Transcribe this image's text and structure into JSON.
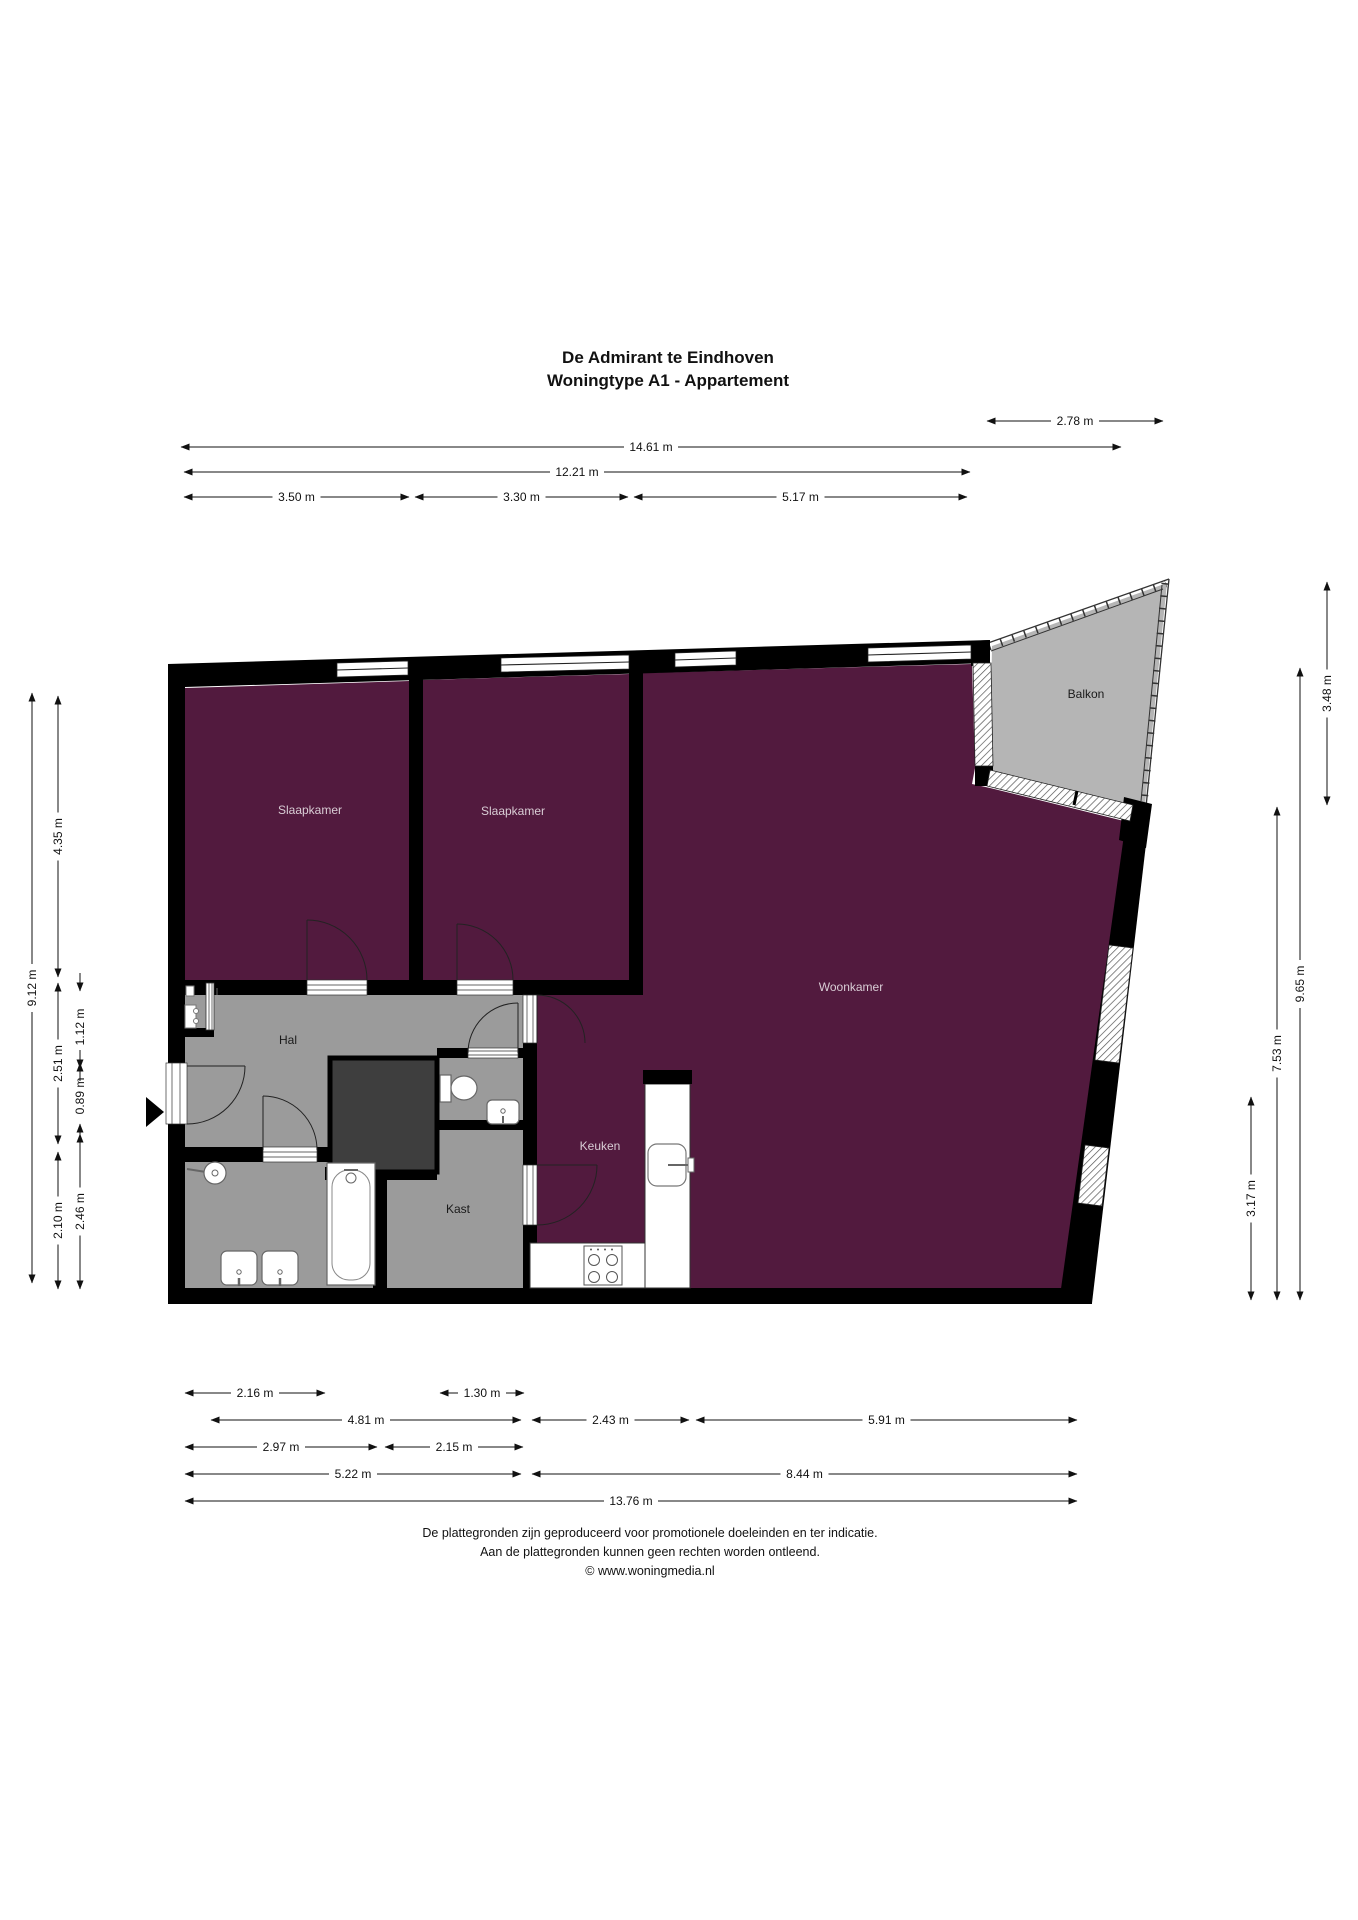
{
  "title": {
    "line1": "De Admirant te Eindhoven",
    "line2": "Woningtype A1 - Appartement"
  },
  "rooms": [
    {
      "name": "Slaapkamer",
      "x": 310,
      "y": 814,
      "tone": "light"
    },
    {
      "name": "Slaapkamer",
      "x": 513,
      "y": 815,
      "tone": "light"
    },
    {
      "name": "Woonkamer",
      "x": 851,
      "y": 991,
      "tone": "light"
    },
    {
      "name": "Keuken",
      "x": 600,
      "y": 1150,
      "tone": "light"
    },
    {
      "name": "Hal",
      "x": 288,
      "y": 1044,
      "tone": "dark"
    },
    {
      "name": "Kast",
      "x": 458,
      "y": 1213,
      "tone": "dark"
    },
    {
      "name": "Balkon",
      "x": 1086,
      "y": 698,
      "tone": "dark"
    }
  ],
  "dimensions": {
    "top": [
      {
        "label": "2.78 m",
        "x1": 987,
        "x2": 1163,
        "y": 421
      },
      {
        "label": "14.61 m",
        "x1": 181,
        "x2": 1121,
        "y": 447
      },
      {
        "label": "12.21 m",
        "x1": 184,
        "x2": 970,
        "y": 472
      },
      {
        "label": "3.50 m",
        "x1": 184,
        "x2": 409,
        "y": 497
      },
      {
        "label": "3.30 m",
        "x1": 415,
        "x2": 628,
        "y": 497
      },
      {
        "label": "5.17 m",
        "x1": 634,
        "x2": 967,
        "y": 497
      }
    ],
    "bottom": [
      {
        "label": "2.16 m",
        "x1": 185,
        "x2": 325,
        "y": 1393
      },
      {
        "label": "1.30 m",
        "x1": 440,
        "x2": 524,
        "y": 1393
      },
      {
        "label": "4.81 m",
        "x1": 211,
        "x2": 521,
        "y": 1420
      },
      {
        "label": "2.43 m",
        "x1": 532,
        "x2": 689,
        "y": 1420
      },
      {
        "label": "5.91 m",
        "x1": 696,
        "x2": 1077,
        "y": 1420
      },
      {
        "label": "2.97 m",
        "x1": 185,
        "x2": 377,
        "y": 1447
      },
      {
        "label": "2.15 m",
        "x1": 385,
        "x2": 523,
        "y": 1447
      },
      {
        "label": "5.22 m",
        "x1": 185,
        "x2": 521,
        "y": 1474
      },
      {
        "label": "8.44 m",
        "x1": 532,
        "x2": 1077,
        "y": 1474
      },
      {
        "label": "13.76 m",
        "x1": 185,
        "x2": 1077,
        "y": 1501
      }
    ],
    "left": [
      {
        "label": "9.12 m",
        "y1": 693,
        "y2": 1283,
        "x": 32
      },
      {
        "label": "4.35 m",
        "y1": 696,
        "y2": 977,
        "x": 58
      },
      {
        "label": "2.51 m",
        "y1": 983,
        "y2": 1144,
        "x": 58
      },
      {
        "label": "2.10 m",
        "y1": 1152,
        "y2": 1289,
        "x": 58
      },
      {
        "label": "1.12 m",
        "y1": 991,
        "y2": 1063,
        "x": 80
      },
      {
        "label": "0.89 m",
        "y1": 1068,
        "y2": 1124,
        "x": 80
      },
      {
        "label": "2.46 m",
        "y1": 1134,
        "y2": 1289,
        "x": 80
      }
    ],
    "right": [
      {
        "label": "3.48 m",
        "y1": 582,
        "y2": 805,
        "x": 1327
      },
      {
        "label": "9.65 m",
        "y1": 668,
        "y2": 1300,
        "x": 1300
      },
      {
        "label": "7.53 m",
        "y1": 807,
        "y2": 1300,
        "x": 1277
      },
      {
        "label": "3.17 m",
        "y1": 1097,
        "y2": 1300,
        "x": 1251
      }
    ]
  },
  "footer": {
    "lines": [
      "De plattegronden zijn geproduceerd voor promotionele doeleinden en ter indicatie.",
      "Aan de plattegronden kunnen geen rechten worden ontleend.",
      "© www.woningmedia.nl"
    ]
  },
  "colors": {
    "wall": "#000000",
    "living": "#521a3e",
    "hall_gray": "#9b9b9b",
    "balcony_gray": "#b5b5b5",
    "shaft_gray": "#3e3e3e",
    "label_light": "#d9cdd5",
    "label_dark": "#1a1a1a",
    "line": "#111111"
  }
}
